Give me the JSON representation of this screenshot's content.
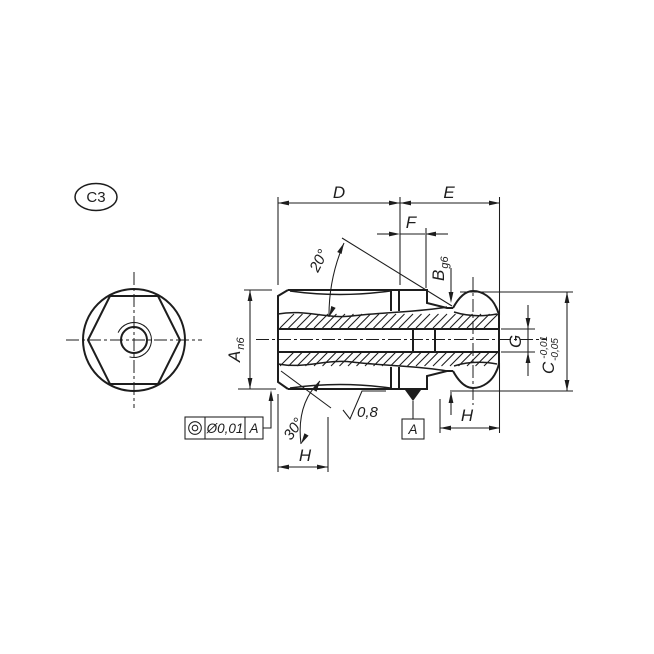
{
  "balloon": "C3",
  "labels": {
    "dim_d": "D",
    "dim_e": "E",
    "dim_f": "F",
    "dim_a": "A",
    "dim_a_fit": "n6",
    "dim_b": "B",
    "dim_b_fit": "g6",
    "dim_c": "C",
    "dim_c_tol_upper": "-0,01",
    "dim_c_tol_lower": "-0,05",
    "dim_g": "G",
    "dim_h_right": "H",
    "dim_h_bottom": "H",
    "angle_taper": "20°",
    "angle_chamfer": "30°",
    "roughness_value": "0,8",
    "fcf_tolerance": "Ø0,01",
    "fcf_datum": "A",
    "datum_label": "A"
  },
  "icons": {
    "fcf_symbol": "concentricity-icon",
    "roughness_symbol": "surface-roughness-icon"
  },
  "colors": {
    "ink": "#1d1d1d",
    "paper": "#ffffff"
  }
}
